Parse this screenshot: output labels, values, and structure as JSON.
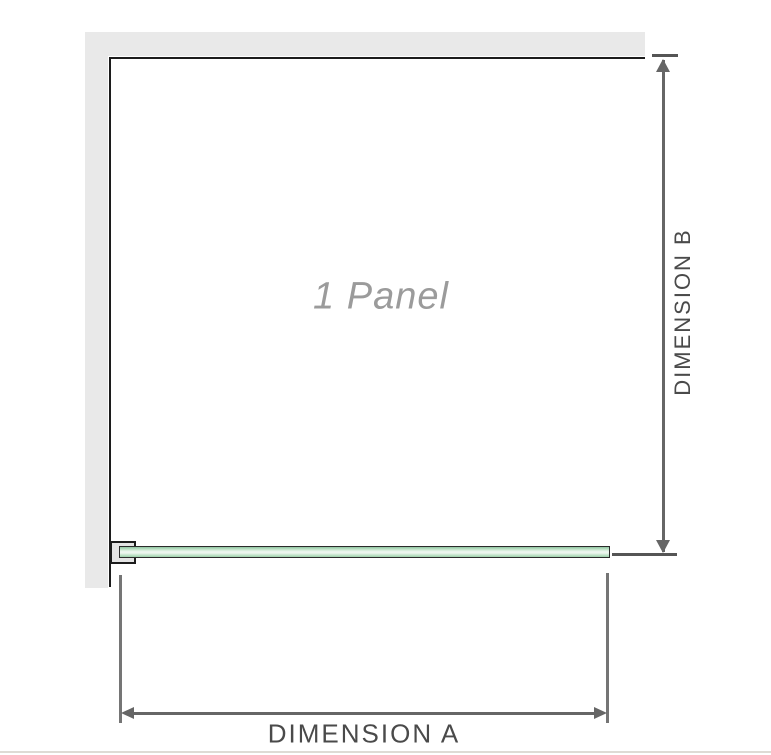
{
  "diagram": {
    "panel_label": "1 Panel",
    "dimension_a_label": "DIMENSION A",
    "dimension_b_label": "DIMENSION B",
    "colors": {
      "wall": "#e9e9e9",
      "outline": "#1c1c1c",
      "dimension_line": "#666666",
      "witness_line": "#757575",
      "tick": "#555555",
      "label_text": "#4a4a4a",
      "panel_label_text": "#9b9b9b",
      "bracket_fill": "#e4e4e4",
      "glass_green_dark": "#8fc4a0",
      "glass_green": "#c3e5cb",
      "glass_green_light": "#ecf6ee",
      "glass_green_bottom": "#9ccfaa",
      "divider": "#dedbd5"
    }
  }
}
